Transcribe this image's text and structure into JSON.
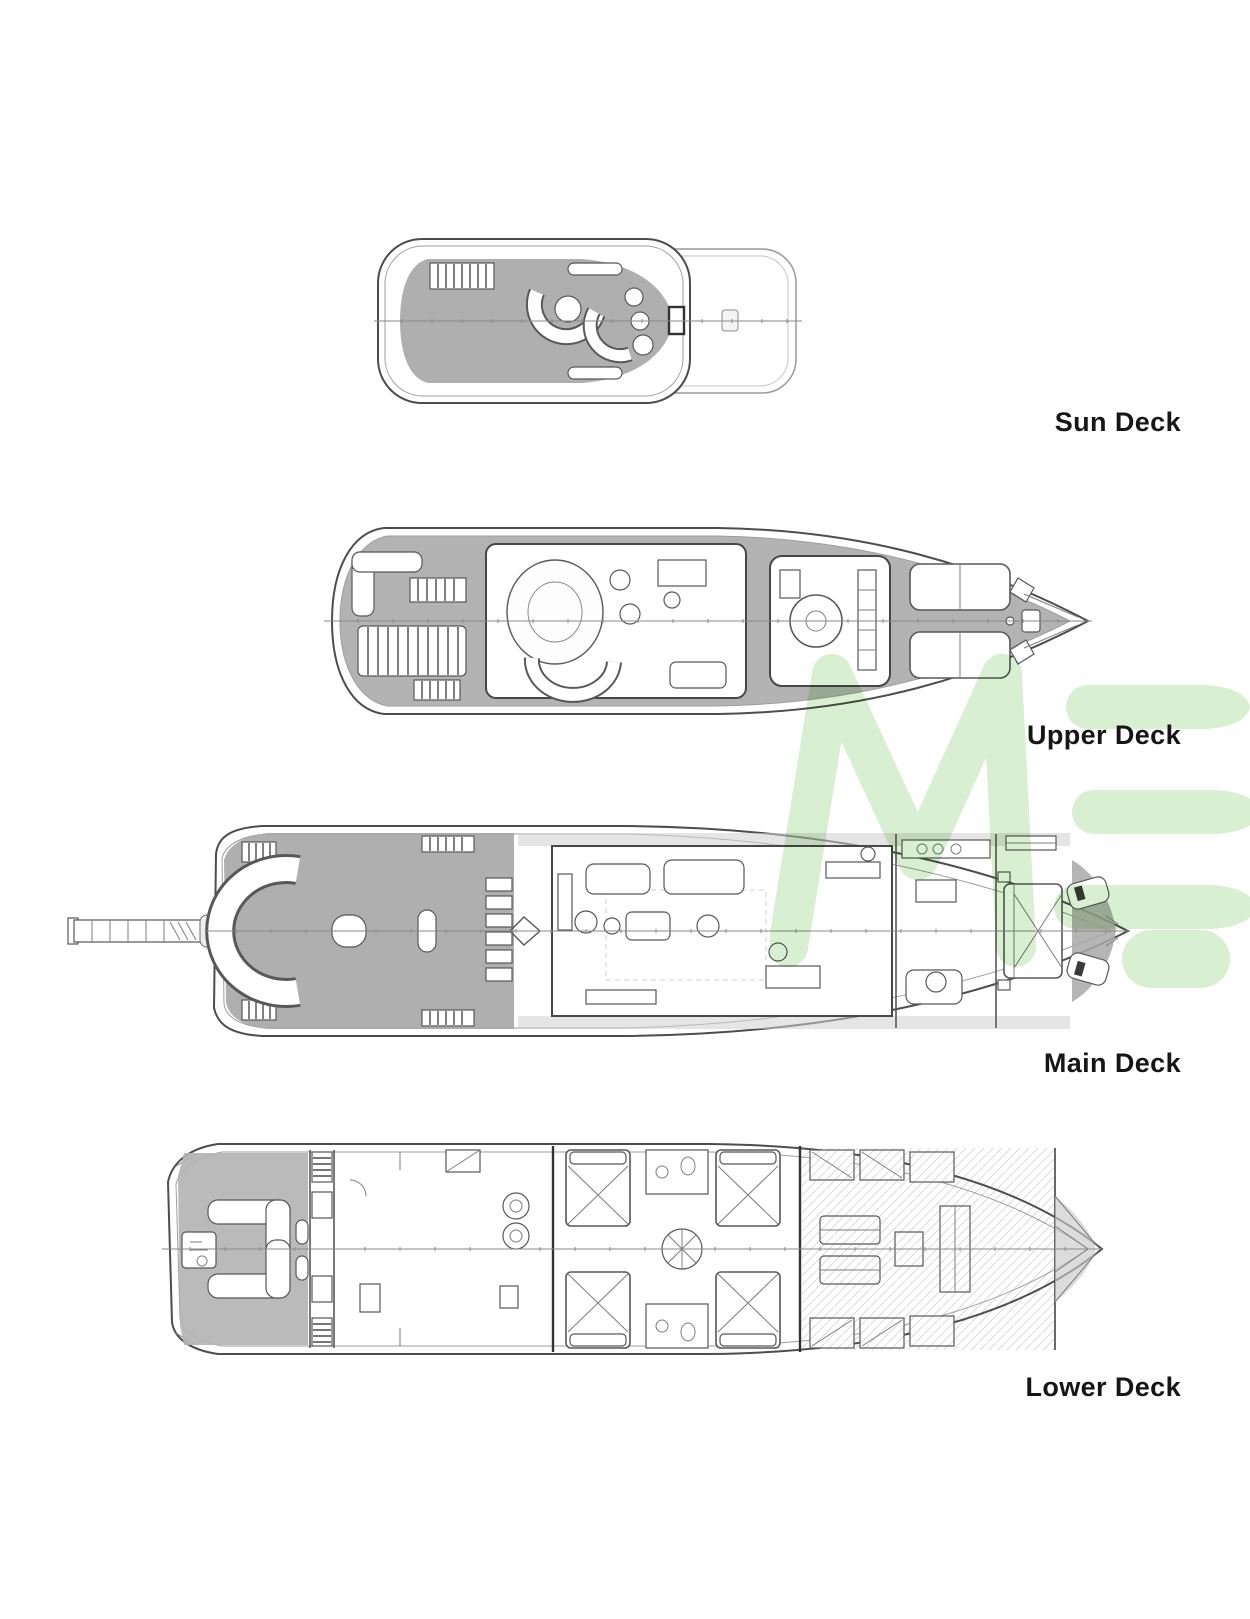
{
  "page": {
    "background": "#ffffff"
  },
  "decks": [
    {
      "id": "sun-deck",
      "label": "Sun Deck"
    },
    {
      "id": "upper-deck",
      "label": "Upper Deck"
    },
    {
      "id": "main-deck",
      "label": "Main Deck"
    },
    {
      "id": "lower-deck",
      "label": "Lower Deck"
    }
  ],
  "watermark": {
    "text": "ME",
    "color": "#d9efd1"
  },
  "colors": {
    "label_text": "#161616",
    "hull_line": "#4d4d4d",
    "deck_shade": "#a8a8a8",
    "watermark_green": "#d9efd1"
  }
}
